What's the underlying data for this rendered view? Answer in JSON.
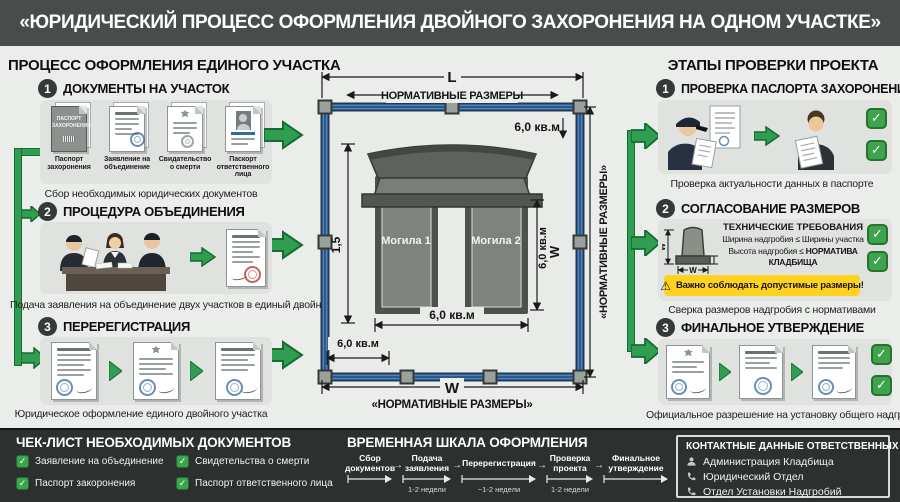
{
  "icons": {
    "check": "✓",
    "warning": "⚠",
    "arrow": "→"
  },
  "colors": {
    "accent_green": "#2f9e50",
    "frame_blue": "#2a5a8e",
    "warning_yellow": "#ffd21f",
    "footer_dark": "#2c302e",
    "header_dark": "#484d4b"
  },
  "header": {
    "title": "«ЮРИДИЧЕСКИЙ ПРОЦЕСС ОФОРМЛЕНИЯ ДВОЙНОГО ЗАХОРОНЕНИЯ НА ОДНОМ УЧАСТКЕ»"
  },
  "left": {
    "title": "ПРОЦЕСС ОФОРМЛЕНИЯ ЕДИНОГО УЧАСТКА",
    "step1": {
      "num": "1",
      "title": "ДОКУМЕНТЫ НА УЧАСТОК",
      "caption": "Сбор необходимых юридических документов",
      "doc1_title": "ПАСПОРТ ЗАХОРОНЕНИЯ",
      "docs": [
        {
          "label": "Паспорт захоронения"
        },
        {
          "label": "Заявление на объединение"
        },
        {
          "label": "Свидательство о смерти"
        },
        {
          "label": "Паскорт ответственного лица"
        }
      ]
    },
    "step2": {
      "num": "2",
      "title": "ПРОЦЕДУРА ОБЪЕДИНЕНИЯ",
      "caption": "Подача заявления на объединение двух участков в единый двойной"
    },
    "step3": {
      "num": "3",
      "title": "ПЕРЕРЕГИСТРАЦИЯ",
      "caption": "Юридическое оформление единого двойного участка"
    }
  },
  "diagram": {
    "dim_length": "L",
    "dim_width": "W",
    "normative_top": "НОРМАТИВНЫЕ РАЗМЕРЫ",
    "normative_bottom": "«НОРМАТИВНЫЕ РАЗМЕРЫ»",
    "normative_right": "«НОРМАТИВНЫЕ РАЗМЕРЫ»",
    "area_top": "6,0 кв.м",
    "area_side": "6,0 кв.м",
    "area_bottom": "6,0 кв.м",
    "area_corner": "6,0 кв.м",
    "side_w": "W",
    "height_mark": "1,5",
    "grave1": "Могила 1",
    "grave2": "Могила 2"
  },
  "right": {
    "title": "ЭТАПЫ ПРОВЕРКИ ПРОЕКТА",
    "step1": {
      "num": "1",
      "title": "ПРОВЕРКА ПАСЛОРТА ЗАХОРОНЕНИЯ",
      "caption": "Проверка актуальности данных в паспорте"
    },
    "step2": {
      "num": "2",
      "title": "СОГЛАСОВАНИЕ РАЗМЕРОВ",
      "caption": "Сверка размеров надгробия с нормативами",
      "tech_title": "ТЕХНИЧЕСКИЕ ТРЕБОВАНИЯ",
      "rule1": "Ширина надгробия ≤ Ширины участка",
      "rule2a": "Высота надгробия ≤ ",
      "rule2b": "НОРМАТИВА КЛАДБИЩА",
      "warning": "Важно соблюдать допустимые размеры!",
      "dim_w_vertical": "W",
      "dim_w_horizontal": "W"
    },
    "step3": {
      "num": "3",
      "title": "ФИНАЛЬНОЕ УТВЕРЖДЕНИЕ",
      "caption": "Официальное разрешение на установку общего надгробия"
    }
  },
  "footer": {
    "checklist": {
      "title": "ЧЕК-ЛИСТ НЕОБХОДИМЫХ ДОКУМЕНТОВ",
      "items": [
        {
          "label": "Заявление на объединение"
        },
        {
          "label": "Свидетельства о смерти"
        },
        {
          "label": "Паспорт закоронения"
        },
        {
          "label": "Паспорт ответственного лица"
        }
      ]
    },
    "timeline": {
      "title": "ВРЕМЕННАЯ ШКАЛА ОФОРМЛЕНИЯ",
      "stages": [
        {
          "label": "Сбор документов",
          "duration": ""
        },
        {
          "label": "Подача заявления",
          "duration": "1-2 недели"
        },
        {
          "label": "Перерегистрация",
          "duration": "~1-2 недели"
        },
        {
          "label": "Проверка проекта",
          "duration": "1-2 недели"
        },
        {
          "label": "Финальное утверждение",
          "duration": ""
        }
      ]
    },
    "contacts": {
      "title": "КОНТАКТНЫЕ ДАННЫЕ ОТВЕТСТВЕННЫХ ЛИЦ",
      "items": [
        {
          "icon": "person",
          "label": "Администрация Кладбища"
        },
        {
          "icon": "phone",
          "label": "Юридический Отдел"
        },
        {
          "icon": "phone",
          "label": "Отдел Установки Надгробий"
        }
      ]
    }
  }
}
